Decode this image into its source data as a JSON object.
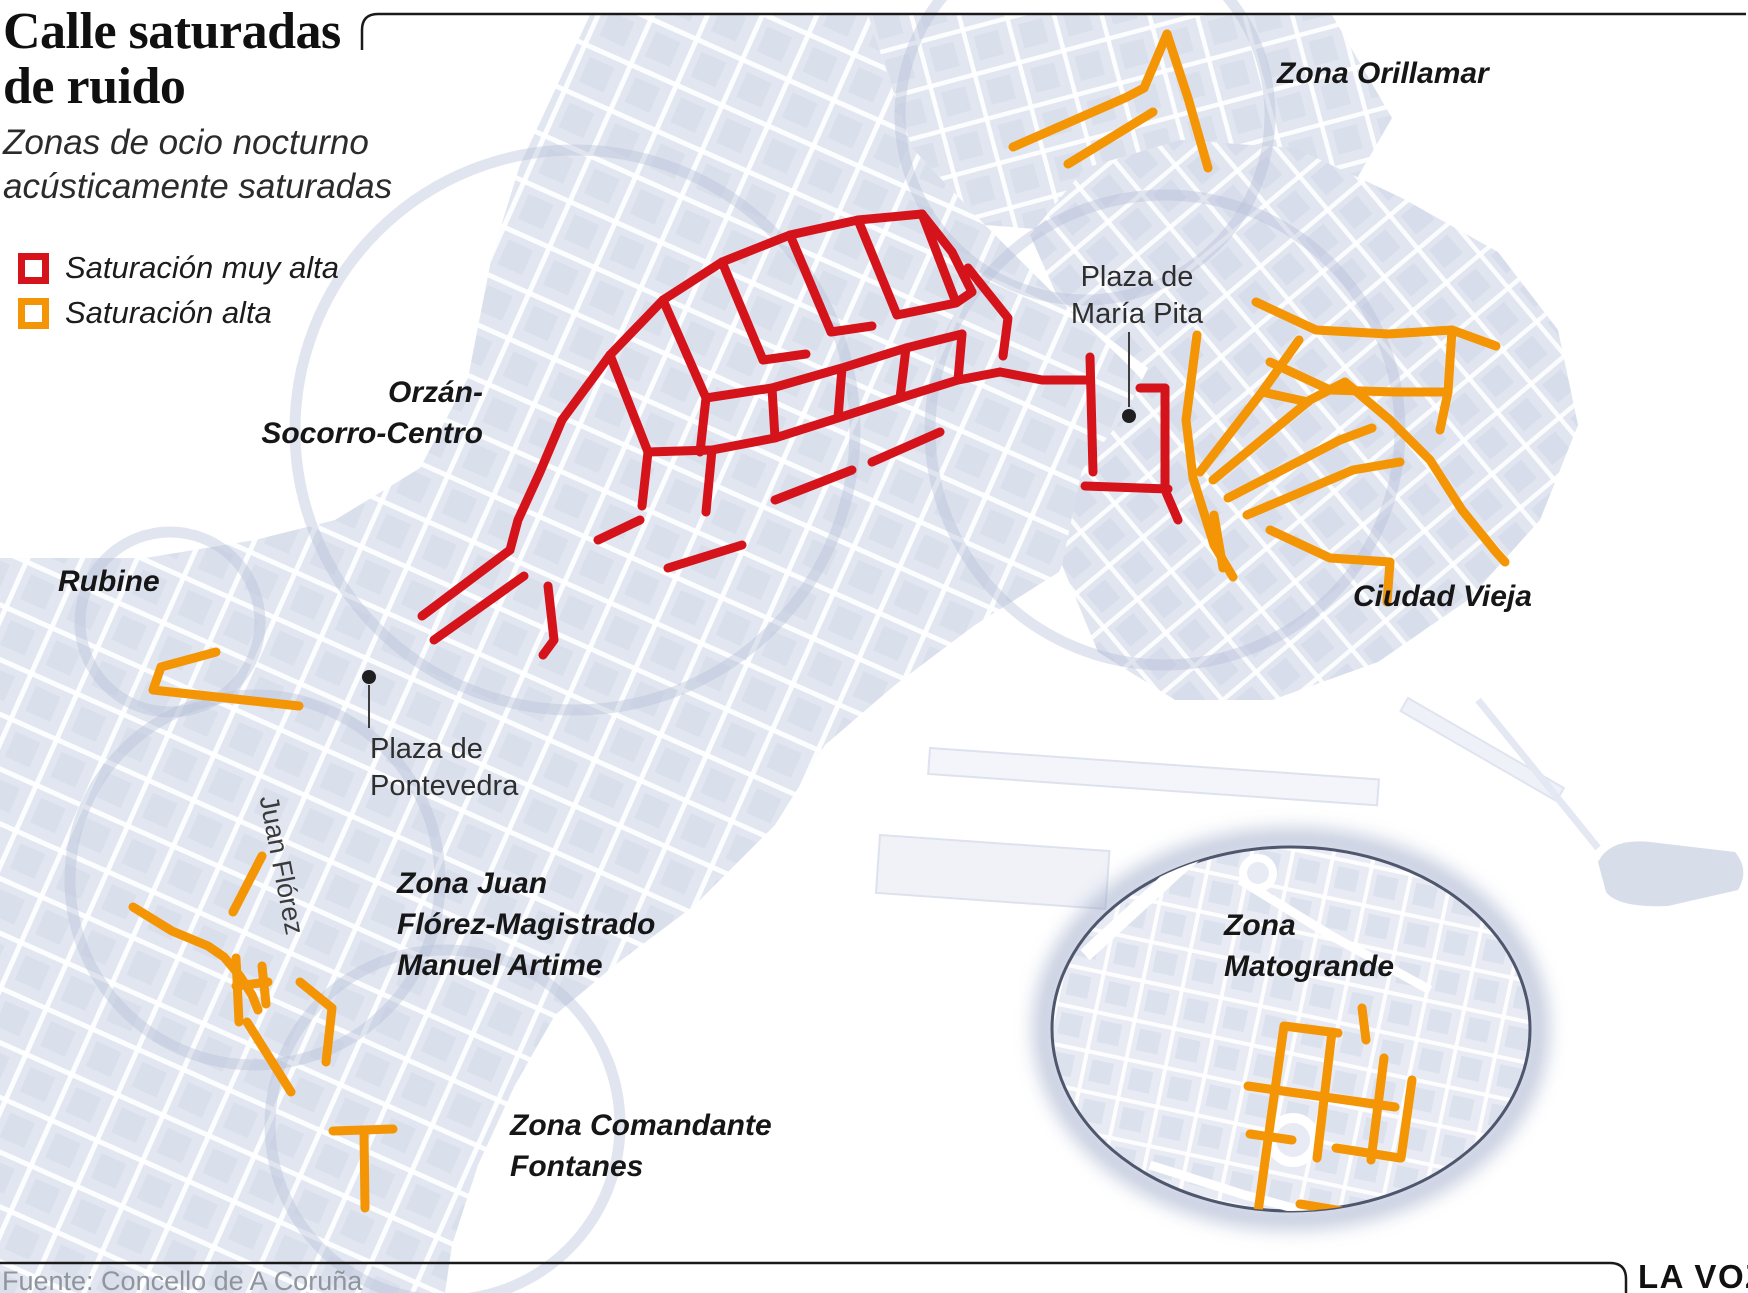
{
  "header": {
    "title_line1": "Calle saturadas",
    "title_line2": "de ruido",
    "subtitle_line1": "Zonas de ocio nocturno",
    "subtitle_line2": "acústicamente saturadas"
  },
  "legend": {
    "very_high": {
      "label": "Saturación muy alta",
      "color": "#d5131b"
    },
    "high": {
      "label": "Saturación alta",
      "color": "#f39504"
    }
  },
  "labels": {
    "zona_orillamar": "Zona Orillamar",
    "orzan_line1": "Orzán-",
    "orzan_line2": "Socorro-Centro",
    "rubine": "Rubine",
    "ciudad_vieja": "Ciudad Vieja",
    "maria_pita_line1": "Plaza de",
    "maria_pita_line2": "María Pita",
    "pontevedra_line1": "Plaza de",
    "pontevedra_line2": "Pontevedra",
    "juan_florez": "Juan Flórez",
    "zona_jf_line1": "Zona Juan",
    "zona_jf_line2": "Flórez-Magistrado",
    "zona_jf_line3": "Manuel Artime",
    "comandante_line1": "Zona Comandante",
    "comandante_line2": "Fontanes",
    "matogrande_line1": "Zona",
    "matogrande_line2": "Matogrande"
  },
  "footer": {
    "source": "Fuente: Concello de A Coruña",
    "brand": "LA VOZ"
  },
  "map": {
    "colors": {
      "very_high": "#d5131b",
      "high": "#f39504"
    },
    "stroke_width": 9,
    "networks": {
      "very_high": {
        "color": "#d5131b",
        "segments": [
          [
            [
              562,
              420
            ],
            [
              610,
              355
            ],
            [
              663,
              300
            ],
            [
              722,
              262
            ],
            [
              790,
              235
            ],
            [
              858,
              220
            ],
            [
              922,
              214
            ]
          ],
          [
            [
              922,
              214
            ],
            [
              952,
              252
            ],
            [
              972,
              292
            ]
          ],
          [
            [
              610,
              355
            ],
            [
              648,
              452
            ]
          ],
          [
            [
              663,
              300
            ],
            [
              706,
              398
            ],
            [
              700,
              452
            ]
          ],
          [
            [
              722,
              262
            ],
            [
              763,
              360
            ]
          ],
          [
            [
              790,
              235
            ],
            [
              831,
              332
            ]
          ],
          [
            [
              858,
              220
            ],
            [
              897,
              315
            ]
          ],
          [
            [
              922,
              214
            ],
            [
              955,
              300
            ]
          ],
          [
            [
              648,
              452
            ],
            [
              712,
              450
            ],
            [
              775,
              438
            ],
            [
              838,
              418
            ],
            [
              900,
              398
            ],
            [
              958,
              380
            ],
            [
              1000,
              372
            ]
          ],
          [
            [
              706,
              398
            ],
            [
              772,
              388
            ],
            [
              842,
              368
            ],
            [
              906,
              348
            ],
            [
              962,
              334
            ]
          ],
          [
            [
              897,
              315
            ],
            [
              956,
              303
            ],
            [
              972,
              292
            ]
          ],
          [
            [
              763,
              360
            ],
            [
              806,
              354
            ]
          ],
          [
            [
              831,
              332
            ],
            [
              872,
              326
            ]
          ],
          [
            [
              562,
              420
            ],
            [
              540,
              472
            ],
            [
              518,
              520
            ],
            [
              510,
              550
            ]
          ],
          [
            [
              510,
              550
            ],
            [
              422,
              616
            ]
          ],
          [
            [
              524,
              576
            ],
            [
              434,
              640
            ]
          ],
          [
            [
              548,
              586
            ],
            [
              554,
              640
            ],
            [
              543,
              655
            ]
          ],
          [
            [
              648,
              452
            ],
            [
              642,
              506
            ]
          ],
          [
            [
              712,
              450
            ],
            [
              706,
              512
            ]
          ],
          [
            [
              775,
              500
            ],
            [
              852,
              470
            ]
          ],
          [
            [
              872,
              462
            ],
            [
              940,
              432
            ]
          ],
          [
            [
              968,
              268
            ],
            [
              1008,
              318
            ],
            [
              1003,
              356
            ]
          ],
          [
            [
              1000,
              372
            ],
            [
              1042,
              380
            ],
            [
              1090,
              380
            ]
          ],
          [
            [
              1090,
              357
            ],
            [
              1093,
              472
            ]
          ],
          [
            [
              1085,
              486
            ],
            [
              1168,
              489
            ]
          ],
          [
            [
              1165,
              388
            ],
            [
              1165,
              490
            ]
          ],
          [
            [
              1140,
              388
            ],
            [
              1165,
              388
            ]
          ],
          [
            [
              1165,
              490
            ],
            [
              1178,
              520
            ]
          ],
          [
            [
              838,
              418
            ],
            [
              842,
              368
            ]
          ],
          [
            [
              900,
              398
            ],
            [
              906,
              348
            ]
          ],
          [
            [
              958,
              380
            ],
            [
              962,
              334
            ]
          ],
          [
            [
              775,
              438
            ],
            [
              772,
              388
            ]
          ],
          [
            [
              598,
              540
            ],
            [
              640,
              520
            ]
          ],
          [
            [
              668,
              568
            ],
            [
              742,
              545
            ]
          ]
        ]
      },
      "high": {
        "color": "#f39504",
        "segments": [
          [
            [
              1013,
              147
            ],
            [
              1127,
              97
            ],
            [
              1144,
              88
            ]
          ],
          [
            [
              1144,
              88
            ],
            [
              1167,
              34
            ]
          ],
          [
            [
              1167,
              34
            ],
            [
              1188,
              98
            ],
            [
              1208,
              168
            ]
          ],
          [
            [
              1068,
              164
            ],
            [
              1153,
              112
            ]
          ],
          [
            [
              216,
              652
            ],
            [
              161,
              667
            ],
            [
              153,
              690
            ],
            [
              299,
              706
            ]
          ],
          [
            [
              1197,
              335
            ],
            [
              1186,
              420
            ],
            [
              1193,
              478
            ],
            [
              1214,
              545
            ],
            [
              1233,
              577
            ]
          ],
          [
            [
              1200,
              472
            ],
            [
              1262,
              392
            ],
            [
              1299,
              340
            ]
          ],
          [
            [
              1214,
              515
            ],
            [
              1223,
              568
            ]
          ],
          [
            [
              1213,
              480
            ],
            [
              1310,
              400
            ],
            [
              1345,
              382
            ]
          ],
          [
            [
              1228,
              498
            ],
            [
              1340,
              440
            ],
            [
              1372,
              428
            ]
          ],
          [
            [
              1247,
              515
            ],
            [
              1353,
              470
            ],
            [
              1400,
              462
            ]
          ],
          [
            [
              1256,
              302
            ],
            [
              1316,
              330
            ],
            [
              1388,
              334
            ],
            [
              1452,
              330
            ],
            [
              1496,
              346
            ]
          ],
          [
            [
              1345,
              382
            ],
            [
              1390,
              420
            ],
            [
              1430,
              460
            ],
            [
              1462,
              510
            ]
          ],
          [
            [
              1452,
              330
            ],
            [
              1448,
              392
            ],
            [
              1440,
              430
            ]
          ],
          [
            [
              1462,
              510
            ],
            [
              1496,
              552
            ],
            [
              1505,
              562
            ]
          ],
          [
            [
              1270,
              362
            ],
            [
              1330,
              390
            ],
            [
              1395,
              392
            ],
            [
              1448,
              392
            ]
          ],
          [
            [
              1262,
              392
            ],
            [
              1308,
              402
            ]
          ],
          [
            [
              1270,
              530
            ],
            [
              1330,
              558
            ],
            [
              1390,
              562
            ]
          ],
          [
            [
              1390,
              562
            ],
            [
              1387,
              602
            ]
          ],
          [
            [
              262,
              856
            ],
            [
              233,
              912
            ]
          ],
          [
            [
              133,
              907
            ],
            [
              172,
              931
            ],
            [
              208,
              946
            ],
            [
              224,
              957
            ],
            [
              240,
              976
            ],
            [
              252,
              995
            ],
            [
              258,
              1010
            ]
          ],
          [
            [
              236,
              958
            ],
            [
              239,
              1022
            ]
          ],
          [
            [
              236,
              986
            ],
            [
              268,
              982
            ]
          ],
          [
            [
              262,
              966
            ],
            [
              266,
              1004
            ]
          ],
          [
            [
              300,
              982
            ],
            [
              332,
              1008
            ],
            [
              326,
              1062
            ]
          ],
          [
            [
              247,
              1022
            ],
            [
              291,
              1092
            ]
          ],
          [
            [
              333,
              1131
            ],
            [
              393,
              1129
            ]
          ],
          [
            [
              364,
              1131
            ],
            [
              365,
              1208
            ]
          ]
        ]
      },
      "inset_high": {
        "color": "#f39504",
        "segments": [
          [
            [
              1284,
              1026
            ],
            [
              1271,
              1118
            ],
            [
              1258,
              1212
            ]
          ],
          [
            [
              1332,
              1032
            ],
            [
              1317,
              1158
            ]
          ],
          [
            [
              1384,
              1058
            ],
            [
              1371,
              1160
            ]
          ],
          [
            [
              1412,
              1080
            ],
            [
              1401,
              1158
            ]
          ],
          [
            [
              1284,
              1026
            ],
            [
              1338,
              1033
            ]
          ],
          [
            [
              1248,
              1086
            ],
            [
              1395,
              1107
            ]
          ],
          [
            [
              1250,
              1134
            ],
            [
              1292,
              1140
            ]
          ],
          [
            [
              1336,
              1148
            ],
            [
              1400,
              1158
            ]
          ],
          [
            [
              1362,
              1008
            ],
            [
              1366,
              1040
            ]
          ],
          [
            [
              1300,
              1204
            ],
            [
              1348,
              1212
            ]
          ]
        ]
      }
    },
    "inset": {
      "cx": 1291,
      "cy": 1029,
      "rx": 239,
      "ry": 182
    }
  }
}
